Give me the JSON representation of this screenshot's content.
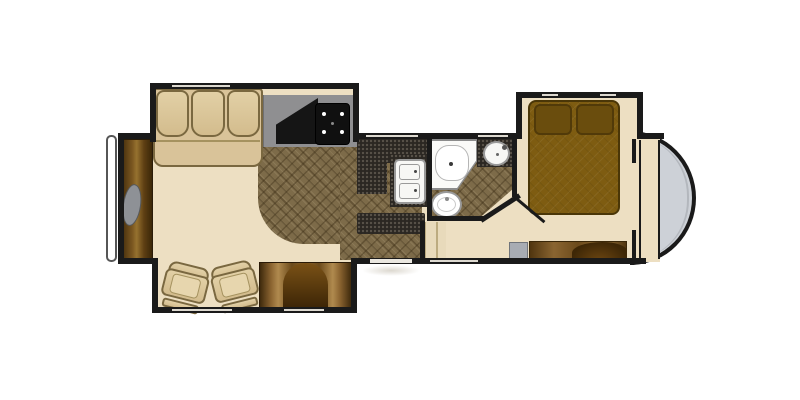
{
  "description": "Top-down floor plan of a fifth-wheel RV travel trailer with three slide-outs",
  "palette": {
    "wall": "#1a1a1a",
    "floor_beige": "#eddfc2",
    "tile_brown": "#7d6b49",
    "counter_speckle_dark": "#2b2722",
    "counter_gray": "#8f8f91",
    "upholstery_tan": "#d9c399",
    "cabinet_wood": "#7a5620",
    "bed_brown": "#7e5c11",
    "front_cap_gray": "#cdd1d7",
    "steps_gray": "#a8acb3",
    "fixture_white": "#f7f7f5",
    "background": "#ffffff"
  },
  "exterior": {
    "front_cap": "curved fifth-wheel front cap",
    "rear_bumper": "rear bumper bar",
    "entry_shadow": "entry door shadow"
  },
  "living_area": {
    "rear_wall_items": [
      "rear entertainment cabinet",
      "television"
    ],
    "top_slide_items": [
      "three-cushion sofa"
    ],
    "bottom_slide_items": [
      "recliner chair",
      "recliner chair",
      "media cabinet with arched center"
    ]
  },
  "kitchen": {
    "items": [
      "gray countertop",
      "corner pantry wedge",
      "range with four burners",
      "dark L-shaped counter",
      "double-bowl sink",
      "kitchen island",
      "brown tile floor"
    ]
  },
  "bathroom": {
    "items": [
      "corner shower",
      "round vanity sink",
      "toilet",
      "tile floor",
      "angled wall",
      "swing door to bedroom hall"
    ]
  },
  "bedroom": {
    "slide_items": [
      "bed",
      "pillow",
      "pillow"
    ],
    "items": [
      "dresser console",
      "curved tv cabinet top",
      "gray entry steps",
      "hall steps",
      "front wardrobe closet"
    ]
  }
}
